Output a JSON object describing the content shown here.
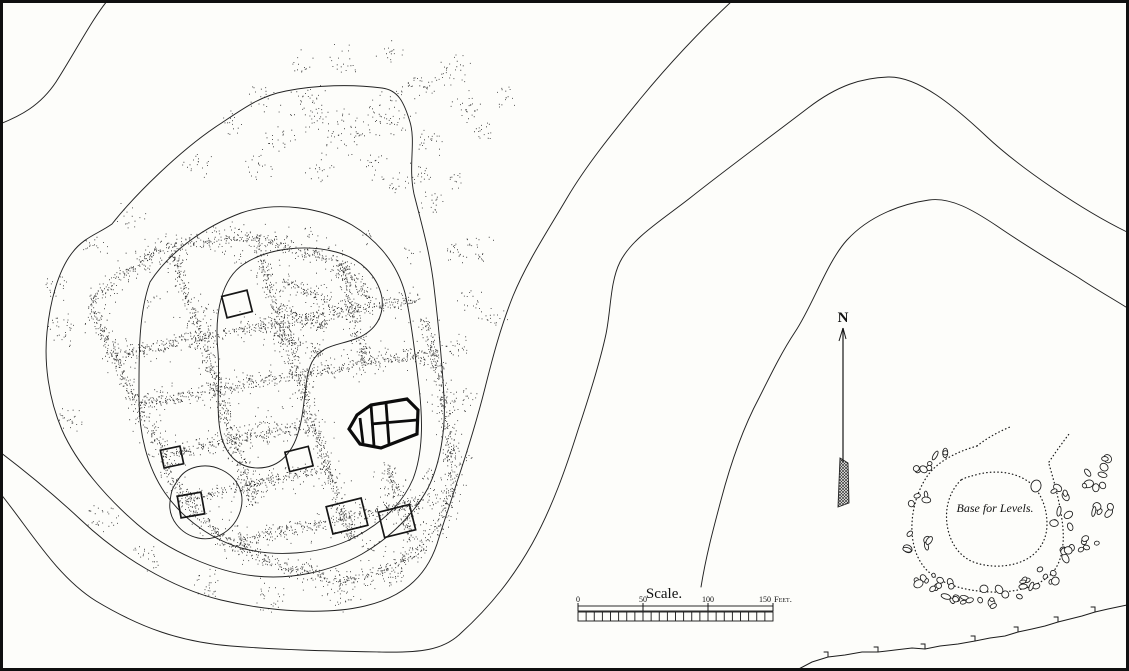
{
  "colors": {
    "ink": "#1c1c1c",
    "paper": "#fdfdfa"
  },
  "seed": 1889,
  "frame": {
    "w": 1129,
    "h": 671
  },
  "north_arrow": {
    "label": "N",
    "x": 843,
    "label_y": 322,
    "tip_y": 328,
    "feather_top": 458,
    "bottom_y": 507
  },
  "scale_bar": {
    "title": "Scale.",
    "unit": "Feet.",
    "x0": 578,
    "x1": 773,
    "y": 606,
    "title_x": 664,
    "title_y": 598,
    "ticks": [
      {
        "label": "0",
        "frac": 0
      },
      {
        "label": "50",
        "frac": 0.3333
      },
      {
        "label": "100",
        "frac": 0.6667
      },
      {
        "label": "150",
        "frac": 1
      }
    ],
    "subdivisions": 24
  },
  "base_for_levels": {
    "label": "Base for Levels.",
    "x": 995,
    "y": 512
  },
  "contours": {
    "stroke": 0.95,
    "paths": [
      "M108,0 C94,16 74,54 56,82 C40,106 20,116 0,124",
      "M112,224 C134,196 180,150 220,124 C244,108 260,96 286,91 C316,85 352,84 382,88 C398,90 404,102 410,122 C416,142 408,166 414,194 C421,222 430,252 434,287 C438,321 442,361 444,397 C446,430 440,464 428,488 C414,514 390,538 362,554 C330,572 290,580 255,576 C215,572 167,550 137,524 C107,498 77,464 62,430 C48,397 44,362 47,332 C50,302 58,271 72,253 C84,237 98,234 112,224",
      "M150,282 C170,251 206,226 241,213 C276,201 321,207 352,225 C377,240 397,263 405,293 C411,319 415,353 419,387 C423,421 423,453 413,479 C401,507 377,527 347,541 C317,554 277,557 245,549 C213,541 183,519 165,493 C147,467 139,433 139,399 C139,359 138,315 150,282",
      "M218,352 C214,312 222,278 244,264 C268,248 306,244 336,252 C360,258 378,276 382,298 C384,316 376,330 358,338 C338,346 322,344 312,362 C304,378 306,402 300,426 C294,452 280,468 258,468 C238,468 224,454 220,430 C216,408 220,378 218,352",
      "M178,480 C186,466 206,462 222,470 C238,478 246,494 240,512 C234,530 216,542 198,538 C180,534 168,518 170,502 C171,492 172,488 178,480",
      "M0,493 C30,530 56,576 96,601 C141,628 181,642 231,646 C281,650 331,651 379,652 C421,653 443,650 460,634 C492,605 514,576 532,544 C552,508 566,468 578,430 C590,394 600,362 606,334 C611,310 610,282 620,262 C632,238 662,220 690,198 C724,171 774,134 808,108 C838,85 862,78 888,77 C918,76 954,106 986,136 C1020,168 1082,210 1127,232",
      "M701,587 C706,556 713,530 721,500 C731,462 743,428 759,398 C773,370 783,350 795,332 C813,305 827,262 847,240 C869,216 901,204 929,200 C951,197 973,210 997,226 C1023,244 1053,262 1079,278 C1097,290 1115,300 1129,309",
      "M733,0 C701,30 669,64 641,98 C615,130 587,164 567,198 C547,232 527,262 513,296 C501,326 493,356 485,388 C477,420 467,452 457,482 C449,508 443,524 437,544 C425,580 399,598 365,606 C327,615 271,612 221,600 C171,588 119,556 81,520 C49,490 21,468 0,452"
    ]
  },
  "knoll": {
    "dotted_paths": [
      "M977,446 C956,452 936,462 926,478 C917,492 911,512 912,532 C913,550 919,564 931,574 C945,585 966,591 991,592 C1017,593 1041,586 1053,572 C1063,560 1065,540 1062,520 C1059,498 1053,478 1049,464",
      "M977,446 C987,438 998,432 1010,427",
      "M1049,462 C1057,450 1063,442 1069,434",
      "M961,480 C949,492 945,508 947,524 C949,540 957,554 971,561 C987,568 1009,568 1025,560 C1039,553 1047,540 1047,524 C1047,508 1041,492 1029,482 C1015,472 997,470 979,474 C972,476 966,477 961,480"
    ],
    "stone_clusters": [
      [
        926,
        468,
        5,
        10
      ],
      [
        920,
        498,
        4,
        9
      ],
      [
        918,
        543,
        6,
        12
      ],
      [
        928,
        578,
        9,
        14
      ],
      [
        958,
        592,
        9,
        14
      ],
      [
        992,
        597,
        8,
        14
      ],
      [
        1022,
        589,
        6,
        11
      ],
      [
        1048,
        578,
        6,
        12
      ],
      [
        1062,
        553,
        5,
        10
      ],
      [
        1064,
        519,
        5,
        10
      ],
      [
        1059,
        491,
        4,
        9
      ],
      [
        1091,
        479,
        6,
        12
      ],
      [
        1101,
        509,
        5,
        10
      ],
      [
        1087,
        544,
        5,
        10
      ],
      [
        1101,
        462,
        3,
        7
      ],
      [
        941,
        454,
        3,
        7
      ]
    ],
    "big_stone": [
      1036,
      486,
      5,
      6
    ]
  },
  "ruin": {
    "wall_segments": [
      [
        90,
        300,
        165,
        245
      ],
      [
        165,
        245,
        255,
        237
      ],
      [
        255,
        237,
        340,
        263
      ],
      [
        340,
        263,
        372,
        300
      ],
      [
        90,
        300,
        112,
        355
      ],
      [
        112,
        355,
        135,
        402
      ],
      [
        135,
        402,
        162,
        452
      ],
      [
        162,
        452,
        180,
        498
      ],
      [
        180,
        498,
        225,
        540
      ],
      [
        225,
        540,
        283,
        568
      ],
      [
        283,
        568,
        348,
        582
      ],
      [
        348,
        582,
        402,
        564
      ],
      [
        402,
        564,
        438,
        528
      ],
      [
        438,
        528,
        452,
        480
      ],
      [
        452,
        480,
        448,
        430
      ],
      [
        448,
        430,
        438,
        375
      ],
      [
        438,
        375,
        425,
        318
      ],
      [
        170,
        247,
        188,
        300
      ],
      [
        188,
        300,
        205,
        352
      ],
      [
        205,
        352,
        222,
        405
      ],
      [
        222,
        405,
        240,
        458
      ],
      [
        240,
        458,
        255,
        505
      ],
      [
        255,
        237,
        270,
        290
      ],
      [
        270,
        290,
        288,
        345
      ],
      [
        288,
        345,
        305,
        398
      ],
      [
        305,
        398,
        322,
        450
      ],
      [
        322,
        450,
        338,
        500
      ],
      [
        338,
        500,
        352,
        540
      ],
      [
        340,
        263,
        352,
        315
      ],
      [
        352,
        315,
        368,
        365
      ],
      [
        385,
        460,
        398,
        505
      ],
      [
        398,
        505,
        412,
        540
      ],
      [
        112,
        357,
        190,
        340
      ],
      [
        190,
        340,
        268,
        325
      ],
      [
        268,
        325,
        345,
        310
      ],
      [
        345,
        310,
        420,
        300
      ],
      [
        138,
        405,
        215,
        390
      ],
      [
        215,
        390,
        292,
        375
      ],
      [
        292,
        375,
        365,
        363
      ],
      [
        365,
        363,
        438,
        352
      ],
      [
        165,
        455,
        240,
        438
      ],
      [
        240,
        438,
        315,
        425
      ],
      [
        185,
        500,
        258,
        483
      ],
      [
        258,
        483,
        330,
        468
      ],
      [
        228,
        543,
        300,
        527
      ],
      [
        300,
        527,
        370,
        513
      ],
      [
        370,
        513,
        438,
        498
      ],
      [
        282,
        282,
        330,
        302
      ],
      [
        278,
        308,
        326,
        328
      ],
      [
        274,
        334,
        322,
        354
      ]
    ],
    "debris_blobs": [
      [
        305,
        110,
        26,
        55
      ],
      [
        345,
        130,
        24,
        50
      ],
      [
        385,
        120,
        26,
        55
      ],
      [
        420,
        90,
        20,
        35
      ],
      [
        450,
        70,
        18,
        30
      ],
      [
        465,
        105,
        16,
        25
      ],
      [
        340,
        60,
        16,
        20
      ],
      [
        390,
        55,
        14,
        16
      ],
      [
        480,
        130,
        14,
        18
      ],
      [
        505,
        95,
        12,
        15
      ],
      [
        430,
        145,
        16,
        22
      ],
      [
        300,
        62,
        12,
        14
      ],
      [
        258,
        98,
        14,
        18
      ],
      [
        280,
        140,
        16,
        20
      ],
      [
        230,
        125,
        14,
        16
      ],
      [
        200,
        165,
        16,
        20
      ],
      [
        260,
        165,
        16,
        20
      ],
      [
        320,
        170,
        16,
        20
      ],
      [
        375,
        165,
        14,
        18
      ],
      [
        420,
        175,
        14,
        18
      ],
      [
        60,
        330,
        16,
        30
      ],
      [
        55,
        288,
        13,
        22
      ],
      [
        72,
        418,
        14,
        24
      ],
      [
        95,
        245,
        13,
        18
      ],
      [
        130,
        215,
        13,
        16
      ],
      [
        150,
        300,
        10,
        10
      ],
      [
        130,
        350,
        9,
        8
      ],
      [
        160,
        395,
        10,
        10
      ],
      [
        102,
        518,
        16,
        28
      ],
      [
        148,
        555,
        14,
        24
      ],
      [
        205,
        582,
        16,
        28
      ],
      [
        268,
        598,
        16,
        28
      ],
      [
        338,
        598,
        14,
        24
      ],
      [
        392,
        577,
        11,
        18
      ],
      [
        310,
        570,
        10,
        12
      ],
      [
        370,
        545,
        10,
        12
      ],
      [
        458,
        348,
        14,
        24
      ],
      [
        464,
        400,
        13,
        20
      ],
      [
        470,
        300,
        12,
        18
      ],
      [
        456,
        252,
        12,
        18
      ],
      [
        432,
        205,
        13,
        20
      ],
      [
        398,
        182,
        14,
        18
      ],
      [
        478,
        250,
        16,
        24
      ],
      [
        492,
        318,
        13,
        18
      ],
      [
        460,
        455,
        12,
        18
      ],
      [
        430,
        478,
        10,
        14
      ],
      [
        455,
        180,
        10,
        12
      ],
      [
        210,
        315,
        10,
        10
      ],
      [
        262,
        420,
        12,
        12
      ],
      [
        240,
        260,
        9,
        8
      ],
      [
        310,
        230,
        9,
        8
      ],
      [
        365,
        240,
        9,
        8
      ],
      [
        410,
        255,
        9,
        8
      ]
    ],
    "rooms": [
      [
        347,
        516,
        36,
        28,
        -14
      ],
      [
        397,
        521,
        32,
        26,
        -14
      ],
      [
        191,
        505,
        24,
        22,
        -10
      ],
      [
        299,
        459,
        24,
        20,
        -14
      ],
      [
        237,
        304,
        26,
        22,
        -14
      ],
      [
        172,
        457,
        20,
        18,
        -12
      ]
    ],
    "building": {
      "outline": [
        [
          349,
          429
        ],
        [
          357,
          415
        ],
        [
          371,
          405
        ],
        [
          407,
          399
        ],
        [
          418,
          410
        ],
        [
          417,
          434
        ],
        [
          381,
          448
        ],
        [
          360,
          444
        ]
      ],
      "inner": [
        [
          360,
          418,
          363,
          443
        ],
        [
          371,
          405,
          374,
          446
        ],
        [
          386,
          403,
          389,
          444
        ],
        [
          371,
          424,
          417,
          420
        ]
      ],
      "stroke": 3.2
    }
  },
  "hachure": {
    "points": [
      [
        795,
        671
      ],
      [
        812,
        662
      ],
      [
        828,
        657
      ],
      [
        845,
        655
      ],
      [
        862,
        652
      ],
      [
        878,
        652
      ],
      [
        895,
        650
      ],
      [
        912,
        648
      ],
      [
        925,
        649
      ],
      [
        940,
        646
      ],
      [
        958,
        644
      ],
      [
        975,
        641
      ],
      [
        990,
        638
      ],
      [
        1005,
        636
      ],
      [
        1018,
        632
      ],
      [
        1032,
        629
      ],
      [
        1045,
        626
      ],
      [
        1058,
        622
      ],
      [
        1070,
        619
      ],
      [
        1082,
        616
      ],
      [
        1095,
        612
      ],
      [
        1108,
        609
      ],
      [
        1127,
        605
      ]
    ],
    "tick_len": 5
  }
}
